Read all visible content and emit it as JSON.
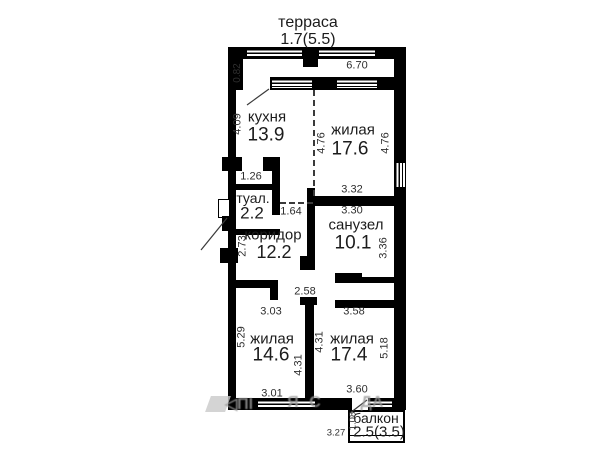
{
  "plan": {
    "type": "apartment-floor-plan",
    "wall_color": "#000000",
    "text_color": "#1c1c1c",
    "watermark_color": "#9a9a9a"
  },
  "terrace": {
    "name": "терраса",
    "area": "1.7(5.5)"
  },
  "rooms": {
    "kitchen": {
      "name": "кухня",
      "area": "13.9"
    },
    "living1": {
      "name": "жилая",
      "area": "17.6"
    },
    "toilet": {
      "name": "туал.",
      "area": "2.2"
    },
    "bathroom": {
      "name": "санузел",
      "area": "10.1"
    },
    "corridor": {
      "name": "коридор",
      "area": "12.2"
    },
    "living2": {
      "name": "жилая",
      "area": "14.6"
    },
    "living3": {
      "name": "жилая",
      "area": "17.4"
    },
    "balcony": {
      "name": "балкон",
      "area": "2.5(3.5)"
    }
  },
  "dims": {
    "d082": "0.82",
    "d670": "6.70",
    "d409": "4.09",
    "d476l": "4.76",
    "d476r": "4.76",
    "d126": "1.26",
    "d332": "3.32",
    "d330": "3.30",
    "d164": "1.64",
    "d336": "3.36",
    "d273": "2.73",
    "d258": "2.58",
    "d303": "3.03",
    "d358": "3.58",
    "d529": "5.29",
    "d431a": "4.31",
    "d431b": "4.31",
    "d518": "5.18",
    "d301": "3.01",
    "d360": "3.60",
    "d327": "3.27",
    "d108": "1.08"
  },
  "watermark": {
    "frag1": "◁ПІ",
    "frag2": "Я",
    "frag3": "С",
    "frag4": "ДА"
  }
}
